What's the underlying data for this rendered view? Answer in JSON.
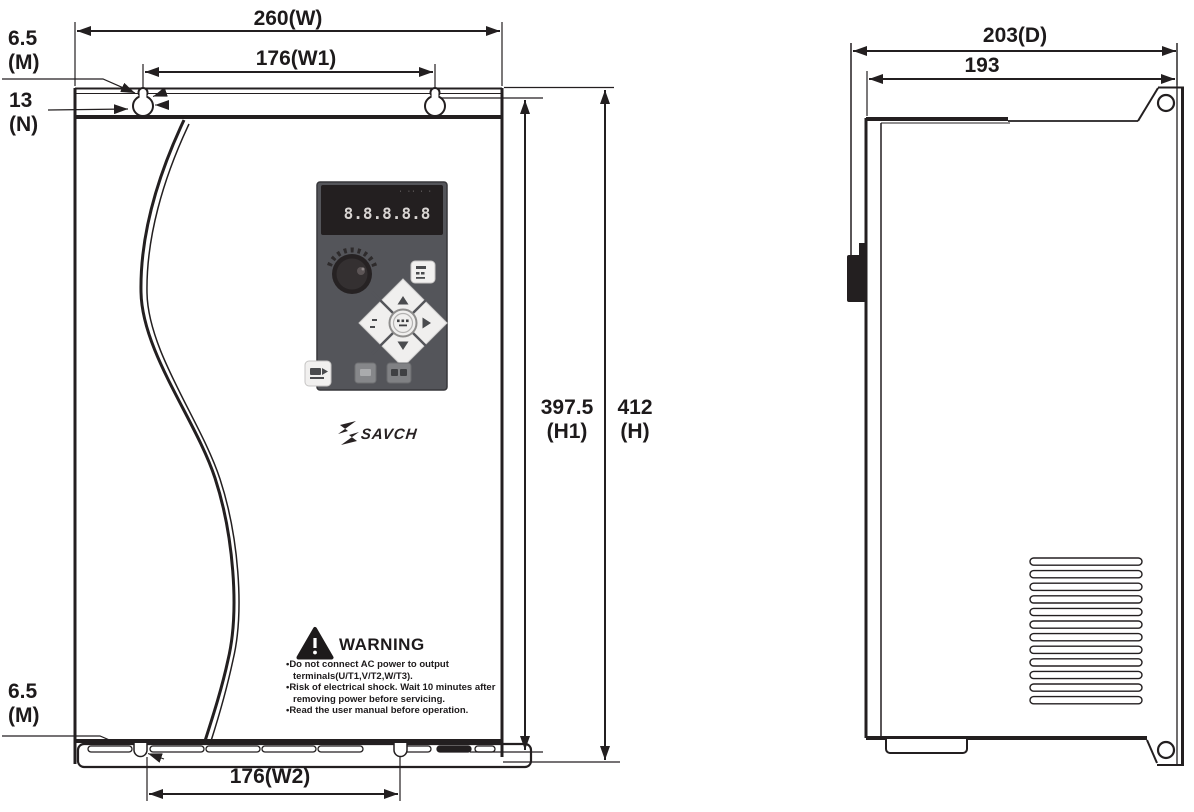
{
  "drawing": {
    "front_view": {
      "dim_width": "260(W)",
      "dim_width1": "176(W1)",
      "dim_width2": "176(W2)",
      "dim_height": "412",
      "dim_height_sub": "(H)",
      "dim_height1": "397.5",
      "dim_height1_sub": "(H1)",
      "dim_m_top": "6.5",
      "dim_m_top_sub": "(M)",
      "dim_n": "13",
      "dim_n_sub": "(N)",
      "dim_m_bottom": "6.5",
      "dim_m_bottom_sub": "(M)"
    },
    "side_view": {
      "dim_depth": "203(D)",
      "dim_depth_inner": "193"
    }
  },
  "keypad": {
    "display_value": "8.8.8.8.8",
    "display_indicators": "· ·· · ·"
  },
  "brand": {
    "name": "SAVCH"
  },
  "warning": {
    "title": "WARNING",
    "items": [
      "•Do not connect AC power to output terminals(U/T1,V/T2,W/T3).",
      "•Risk of electrical shock. Wait 10 minutes after removing power before servicing.",
      "•Read the user manual before operation."
    ]
  },
  "colors": {
    "line": "#231f20",
    "panel": "#54555a",
    "display": "#231f20",
    "button_light": "#f1f0ef",
    "button_gray": "#808184"
  }
}
